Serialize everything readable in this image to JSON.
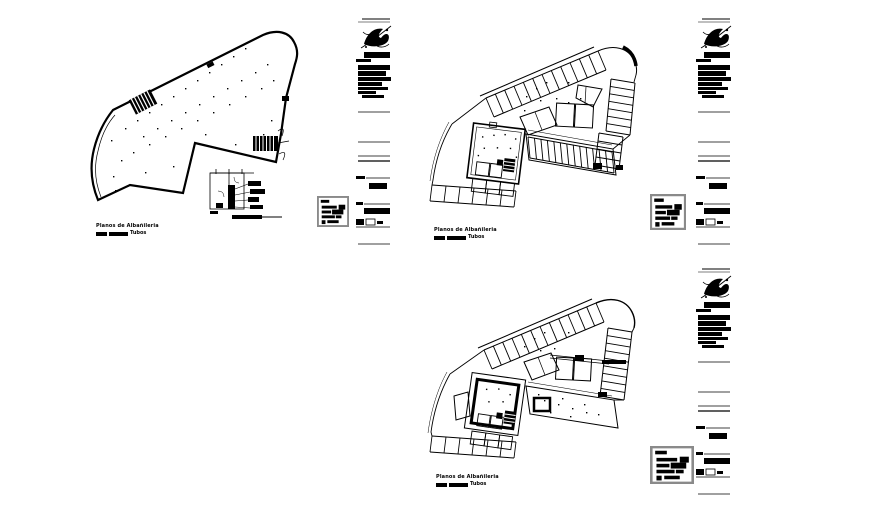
{
  "sheet": {
    "background_color": "#ffffff",
    "ink_color": "#000000",
    "legend_border_color": "#8a8a8a"
  },
  "plans": [
    {
      "caption": "Planos de Albañileria",
      "scale_label": "Tubos"
    },
    {
      "caption": "Planos de Albañileria",
      "scale_label": "Tubos"
    },
    {
      "caption": "Planos de Albañileria",
      "scale_label": "Tubos"
    }
  ],
  "icons": {
    "logo": "emblem-scribble-icon",
    "stairs": "hatched-stair-block",
    "scale": "graphic-scale-bar"
  }
}
